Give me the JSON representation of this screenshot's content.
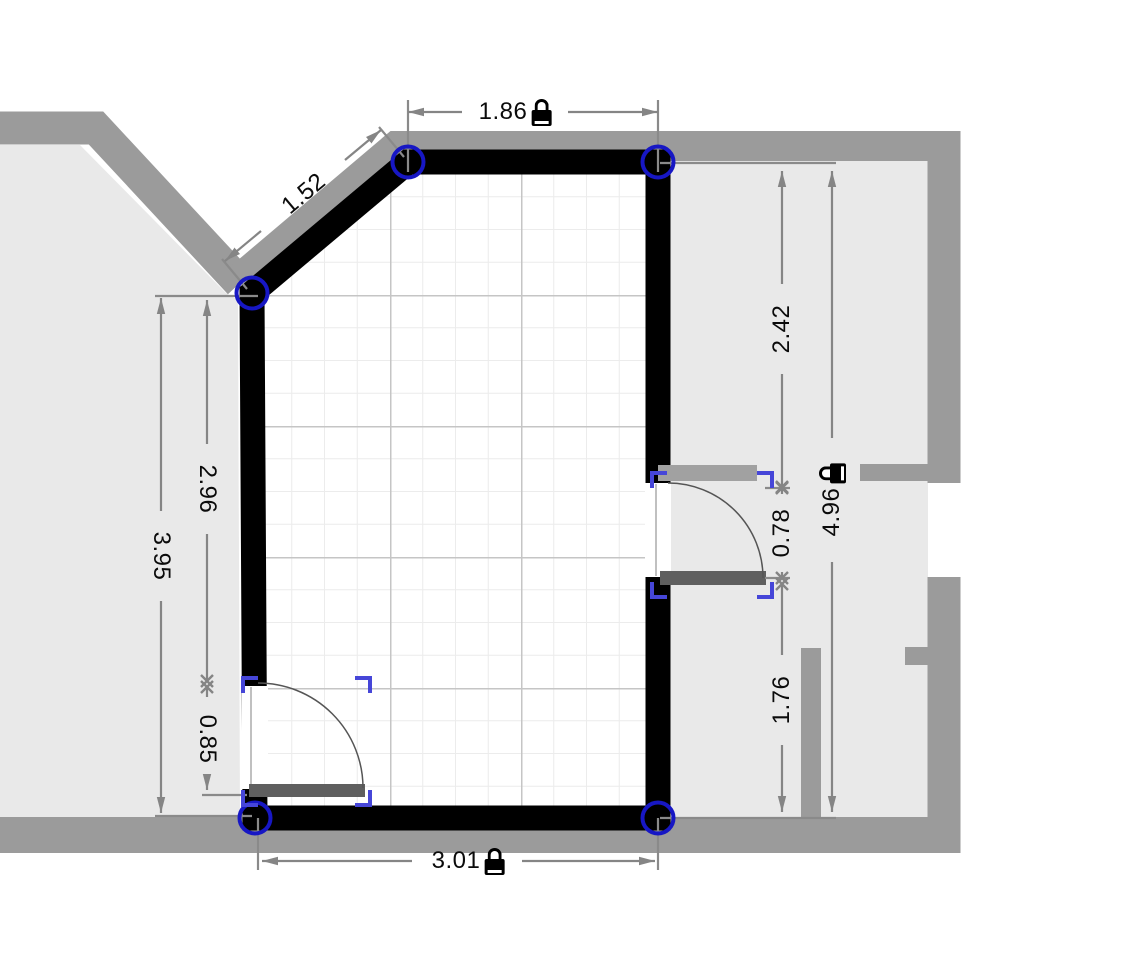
{
  "app": {
    "view": "floor-plan-canvas",
    "selected_object": "door"
  },
  "dims": {
    "top_width": {
      "value": "1.86",
      "locked": true
    },
    "diagonal_wall": {
      "value": "1.52",
      "locked": false
    },
    "left_upper": {
      "value": "2.96",
      "locked": false
    },
    "left_total": {
      "value": "3.95",
      "locked": false
    },
    "left_door_width": {
      "value": "0.85",
      "locked": false
    },
    "right_upper": {
      "value": "2.42",
      "locked": false
    },
    "right_door_width": {
      "value": "0.78",
      "locked": false
    },
    "right_lower": {
      "value": "1.76",
      "locked": false
    },
    "right_total": {
      "value": "4.96",
      "locked": true
    },
    "bottom_width": {
      "value": "3.01",
      "locked": true
    }
  },
  "icons": {
    "lock": "padlock-locked"
  },
  "colors": {
    "room_wall": "#000000",
    "building_wall": "#9b9b9b",
    "adjacent_room_fill": "#e9e9e9",
    "dimension_line": "#858585",
    "vertex_handle": "#1717c4",
    "selection_bracket": "#4646d8",
    "door_leaf": "#5f5f5f",
    "grid_minor": "#ececec",
    "grid_major": "#c5c5c5"
  }
}
